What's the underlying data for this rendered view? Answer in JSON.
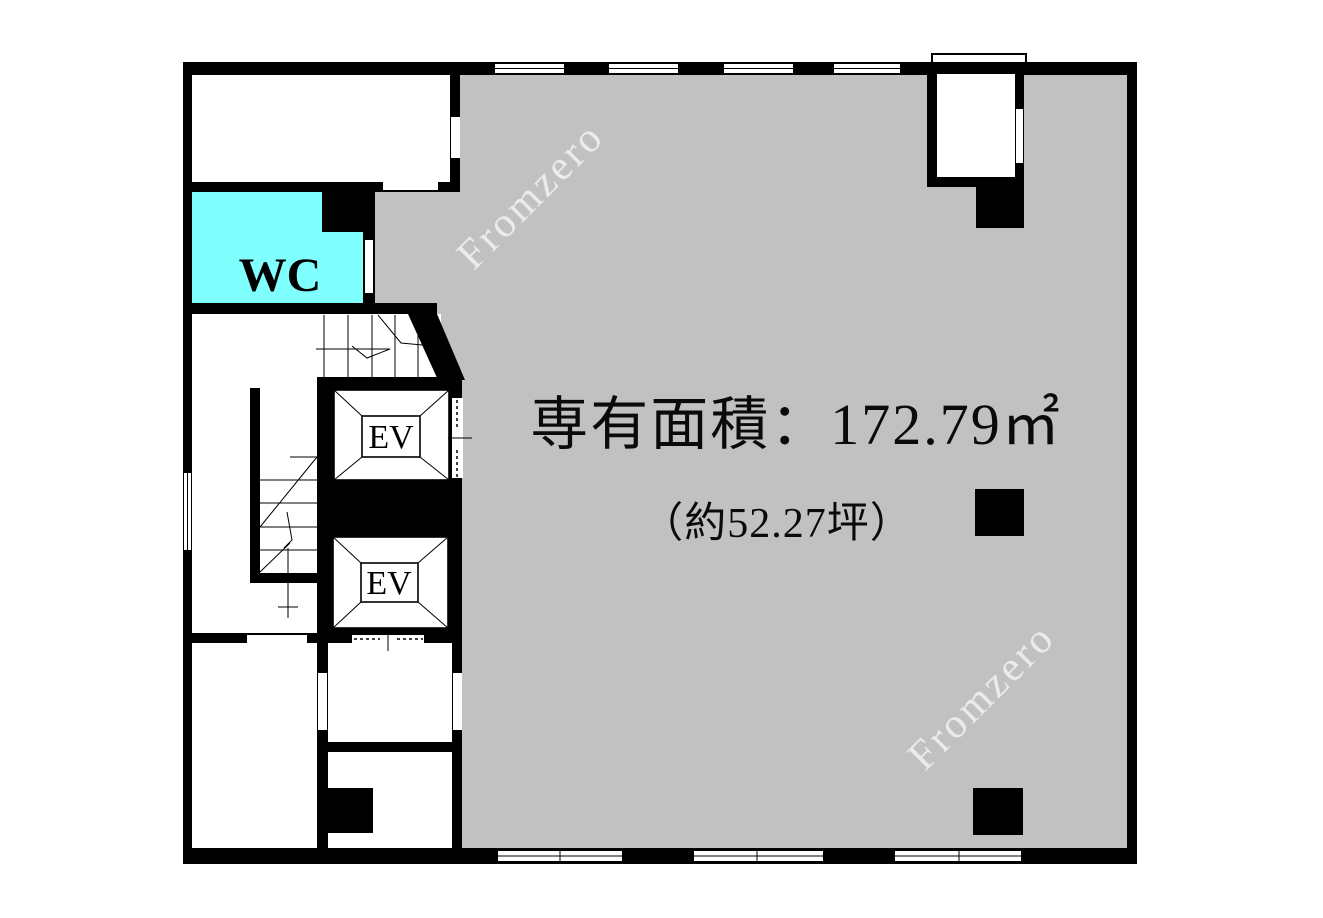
{
  "plan": {
    "area_label": "専有面積：172.79㎡",
    "area_detail": "（約52.27坪）",
    "wc_label": "WC",
    "elevators": [
      {
        "label": "EV"
      },
      {
        "label": "EV"
      }
    ],
    "watermarks": [
      {
        "text": "Fromzero"
      },
      {
        "text": "Fromzero"
      }
    ],
    "colors": {
      "floor_gray": "#c1c1c1",
      "wc_cyan": "#80ffff",
      "wall_black": "#000000",
      "room_white": "#ffffff",
      "watermark": "#f5f5f3"
    }
  }
}
